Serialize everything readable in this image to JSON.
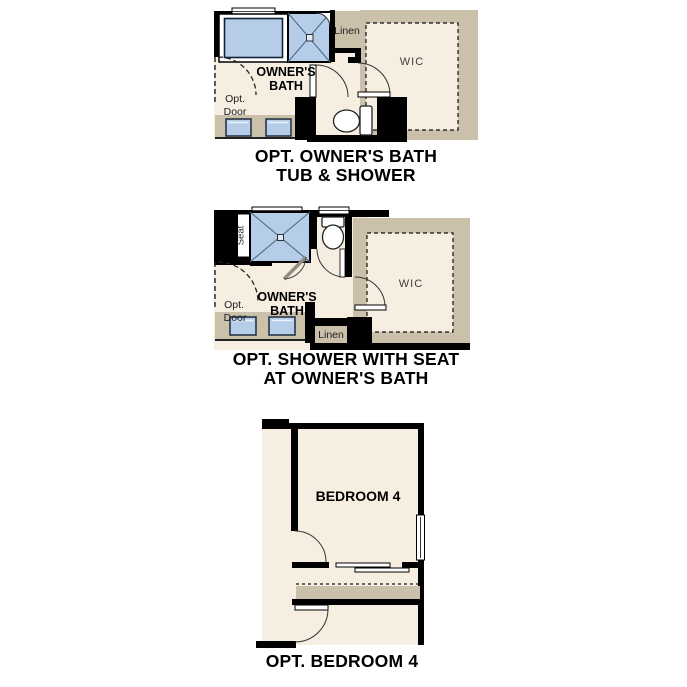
{
  "page": {
    "width": 687,
    "height": 687,
    "background": "#ffffff"
  },
  "palette": {
    "floor": "#f5eee1",
    "wall_tan": "#cbc1aa",
    "fixture_blue": "#b5cde9",
    "wall_black": "#000000",
    "label_gray": "#3f3f3f",
    "text_black": "#000000"
  },
  "figures": [
    {
      "caption_line1": "OPT. OWNER'S BATH",
      "caption_line2": "TUB & SHOWER",
      "labels": {
        "owners": "OWNER'S",
        "bath": "BATH",
        "wic": "WIC",
        "linen": "Linen",
        "opt": "Opt.",
        "door": "Door"
      }
    },
    {
      "caption_line1": "OPT. SHOWER WITH SEAT",
      "caption_line2": "AT OWNER'S BATH",
      "labels": {
        "owners": "OWNER'S",
        "bath": "BATH",
        "wic": "WIC",
        "linen": "Linen",
        "opt": "Opt.",
        "door": "Door",
        "seat": "Seat"
      }
    },
    {
      "caption_line1": "OPT. BEDROOM 4",
      "labels": {
        "bedroom": "BEDROOM 4"
      }
    }
  ]
}
